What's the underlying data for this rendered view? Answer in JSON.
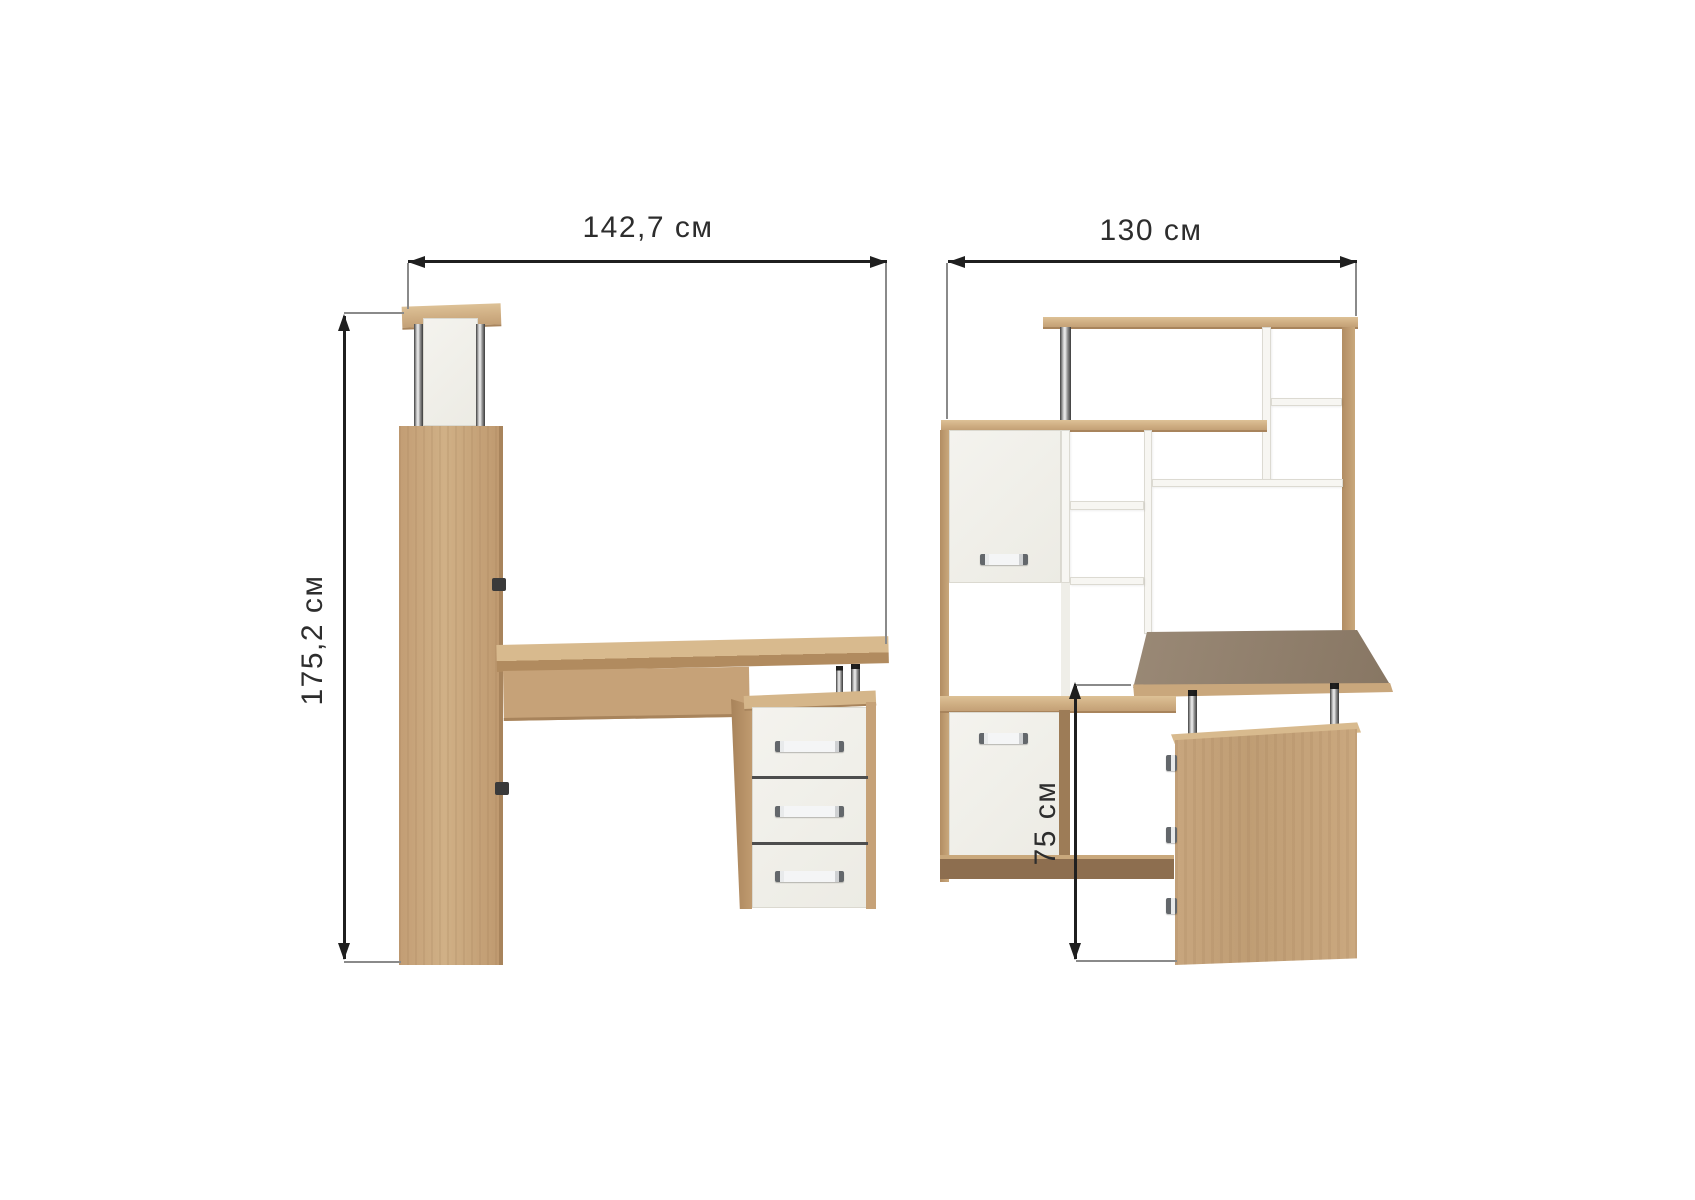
{
  "canvas": {
    "width": 1695,
    "height": 1200,
    "background": "#ffffff"
  },
  "dims": {
    "front_width": "142,7 см",
    "front_height": "175,2 см",
    "side_width": "130 см",
    "side_desk_height": "75 см"
  },
  "colors": {
    "background": "#ffffff",
    "line": "#1f1f1f",
    "ext_line": "#8a8a8a",
    "text": "#2d2d2d",
    "wood_light": "#d6b88d",
    "wood_mid": "#c6a278",
    "wood_edge": "#a8845c",
    "wood_dark": "#8d6e4f",
    "desk_gray": "#8f7e6b",
    "panel_white": "#f2f1eb",
    "panel_border": "#dbd9d0"
  }
}
